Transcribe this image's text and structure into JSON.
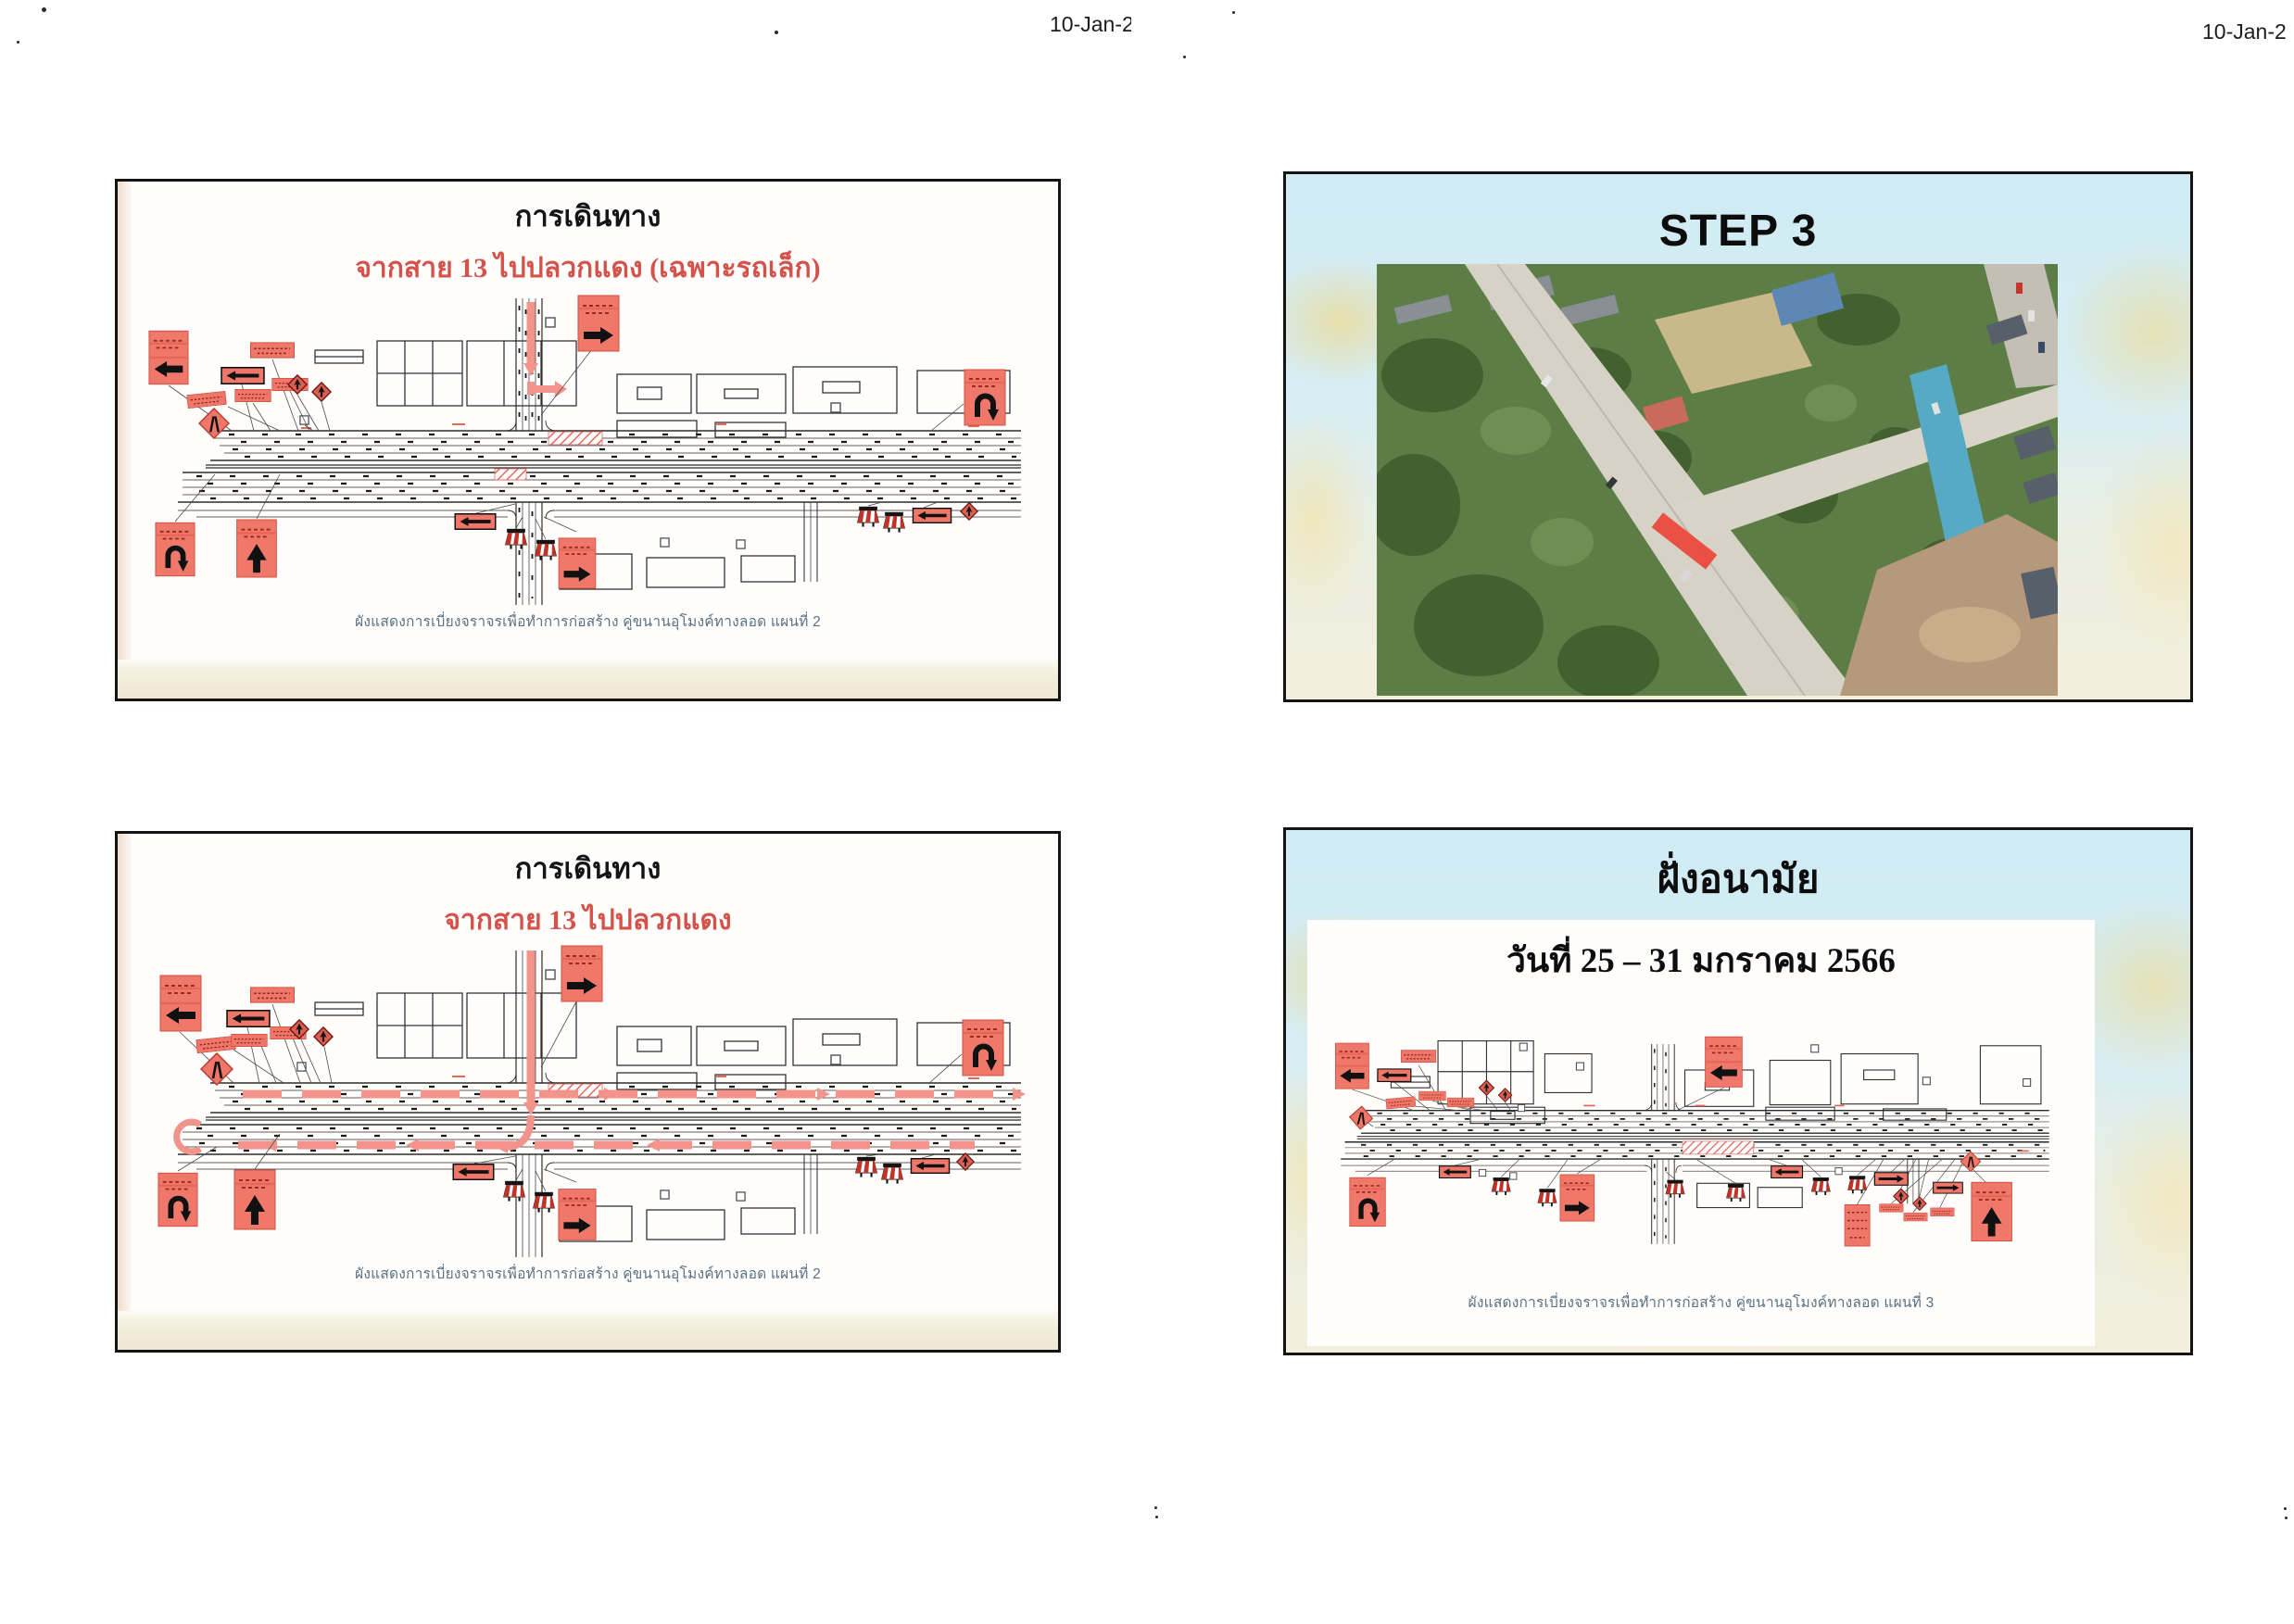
{
  "page": {
    "header_date_center": "10-Jan-2",
    "header_date_right": "10-Jan-2"
  },
  "slide_travel_small_cars": {
    "title": "การเดินทาง",
    "subtitle": "จากสาย 13 ไปปลวกแดง (เฉพาะรถเล็ก)",
    "caption": "ผังแสดงการเบี่ยงจราจรเพื่อทำการก่อสร้าง คู่ขนานอุโมงค์ทางลอด แผนที่ 2"
  },
  "slide_step3": {
    "title": "STEP 3"
  },
  "slide_travel": {
    "title": "การเดินทาง",
    "subtitle": "จากสาย 13 ไปปลวกแดง",
    "caption": "ผังแสดงการเบี่ยงจราจรเพื่อทำการก่อสร้าง คู่ขนานอุโมงค์ทางลอด แผนที่ 2"
  },
  "slide_anamai": {
    "title": "ฝั่งอนามัย",
    "date_range": "วันที่ 25 – 31 มกราคม 2566",
    "caption": "ผังแสดงการเบี่ยงจราจรเพื่อทำการก่อสร้าง คู่ขนานอุโมงค์ทางลอด แผนที่ 3"
  },
  "colors": {
    "sign_red": "#f0786a",
    "subtitle_red": "#d4524a",
    "caption_blue_grey": "#5a7183",
    "slide_bg_blue": "#d3ecf4",
    "watermark_yellow": "#f6dc8c",
    "photo_marker_red": "#ec4437"
  }
}
